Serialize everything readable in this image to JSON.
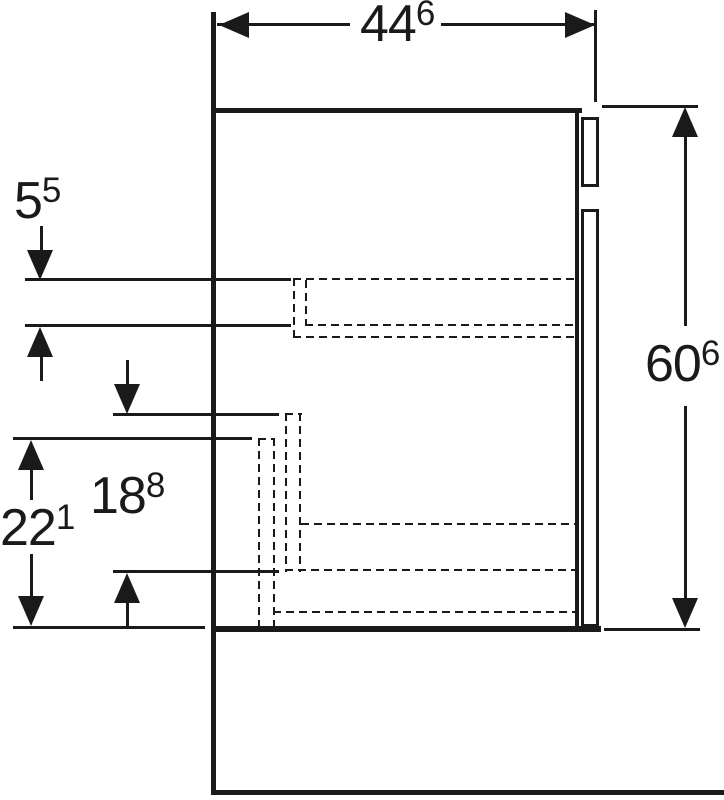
{
  "drawing": {
    "type": "furniture-side-view-technical-drawing",
    "colors": {
      "line": "#1a1a1a",
      "background": "#ffffff"
    },
    "dimensions": {
      "width_top": {
        "main": "44",
        "sup": "6",
        "value_cm": 44.6
      },
      "height_right": {
        "main": "60",
        "sup": "6",
        "value_cm": 60.6
      },
      "upper_drawer": {
        "main": "5",
        "sup": "5",
        "value_cm": 5.5
      },
      "middle_drawer": {
        "main": "18",
        "sup": "8",
        "value_cm": 18.8
      },
      "lower_drawer": {
        "main": "22",
        "sup": "1",
        "value_cm": 22.1
      }
    }
  }
}
